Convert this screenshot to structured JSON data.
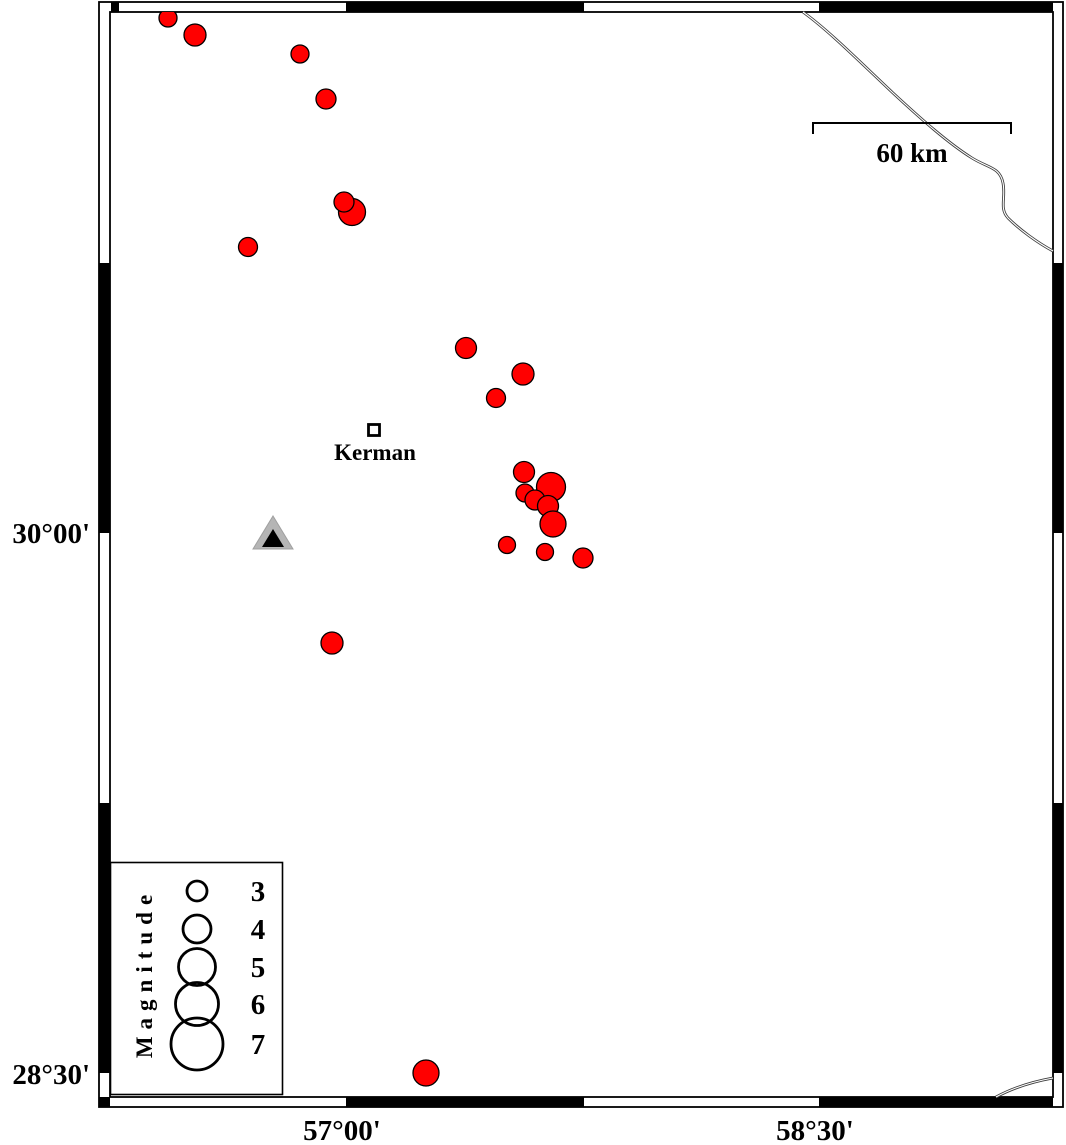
{
  "figure": {
    "width": 1066,
    "height": 1145,
    "background": "#ffffff"
  },
  "axis_labels": {
    "lat_top": "30°00'",
    "lat_bottom": "28°30'",
    "lon_left": "57°00'",
    "lon_right": "58°30'"
  },
  "scalebar": {
    "label": "60 km",
    "x1": 813,
    "x2": 1011,
    "y": 123,
    "tick_drop": 11,
    "label_x": 912,
    "label_y": 162
  },
  "city": {
    "label": "Kerman"
  },
  "station": {
    "outer_points": "253,549 293,549 273,516",
    "inner_points": "262,547 284,547 273,529",
    "outer_fill": "#b5b5b5",
    "inner_fill": "#000000"
  },
  "legend": {
    "title": "Magnitude",
    "box": {
      "x": 110,
      "y": 862,
      "w": 173,
      "h": 233
    },
    "circle_cx": 197,
    "label_x": 258,
    "items": [
      {
        "mag": "3",
        "cy": 891,
        "r": 10
      },
      {
        "mag": "4",
        "cy": 929,
        "r": 14
      },
      {
        "mag": "5",
        "cy": 967,
        "r": 18.5
      },
      {
        "mag": "6",
        "cy": 1004,
        "r": 21.5
      },
      {
        "mag": "7",
        "cy": 1044,
        "r": 26
      }
    ]
  },
  "colors": {
    "earthquake_fill": "#ff0000",
    "earthquake_stroke": "#000000",
    "frame": "#000000",
    "road": "#3c3c3c"
  },
  "map_data": {
    "type": "epicenter-map",
    "earthquakes_px": [
      {
        "x": 168,
        "y": 18,
        "r": 9
      },
      {
        "x": 195,
        "y": 35,
        "r": 11
      },
      {
        "x": 300,
        "y": 54,
        "r": 9
      },
      {
        "x": 326,
        "y": 99,
        "r": 10
      },
      {
        "x": 352,
        "y": 212,
        "r": 13.5
      },
      {
        "x": 344,
        "y": 202,
        "r": 10
      },
      {
        "x": 248,
        "y": 247,
        "r": 9.5
      },
      {
        "x": 466,
        "y": 348,
        "r": 10.5
      },
      {
        "x": 523,
        "y": 374,
        "r": 11
      },
      {
        "x": 496,
        "y": 398,
        "r": 9.5
      },
      {
        "x": 524,
        "y": 472,
        "r": 10.5
      },
      {
        "x": 551,
        "y": 487,
        "r": 14.5
      },
      {
        "x": 525,
        "y": 493,
        "r": 9
      },
      {
        "x": 535,
        "y": 500,
        "r": 10
      },
      {
        "x": 548,
        "y": 506,
        "r": 10.5
      },
      {
        "x": 553,
        "y": 524,
        "r": 13
      },
      {
        "x": 507,
        "y": 545,
        "r": 8.5
      },
      {
        "x": 545,
        "y": 552,
        "r": 8.5
      },
      {
        "x": 583,
        "y": 558,
        "r": 10
      },
      {
        "x": 332,
        "y": 643,
        "r": 11
      },
      {
        "x": 426,
        "y": 1073,
        "r": 13
      }
    ],
    "frame": {
      "outer": {
        "x": 99,
        "y": 2,
        "w": 964,
        "h": 1105
      },
      "inner": {
        "x": 110,
        "y": 12,
        "w": 943,
        "h": 1085
      },
      "black_segments": [
        {
          "x": 111,
          "y": 2,
          "w": 8,
          "h": 10
        },
        {
          "x": 346,
          "y": 2,
          "w": 238,
          "h": 10
        },
        {
          "x": 819,
          "y": 2,
          "w": 234,
          "h": 10
        },
        {
          "x": 99,
          "y": 1097,
          "w": 11,
          "h": 10
        },
        {
          "x": 346,
          "y": 1097,
          "w": 238,
          "h": 10
        },
        {
          "x": 819,
          "y": 1097,
          "w": 234,
          "h": 10
        },
        {
          "x": 99,
          "y": 263,
          "w": 11,
          "h": 270
        },
        {
          "x": 99,
          "y": 803,
          "w": 11,
          "h": 270
        },
        {
          "x": 1053,
          "y": 263,
          "w": 10,
          "h": 270
        },
        {
          "x": 1053,
          "y": 803,
          "w": 10,
          "h": 270
        }
      ]
    },
    "roads": [
      {
        "d": "M 803 12 C 828 30 858 60 893 93 C 920 118 948 143 972 158 C 988 168 1000 167 1003 183 C 1006 198 999 208 1008 218 C 1020 230 1038 243 1053 251"
      },
      {
        "d": "M 996 1097 Q 1020 1084 1053 1078"
      }
    ]
  }
}
